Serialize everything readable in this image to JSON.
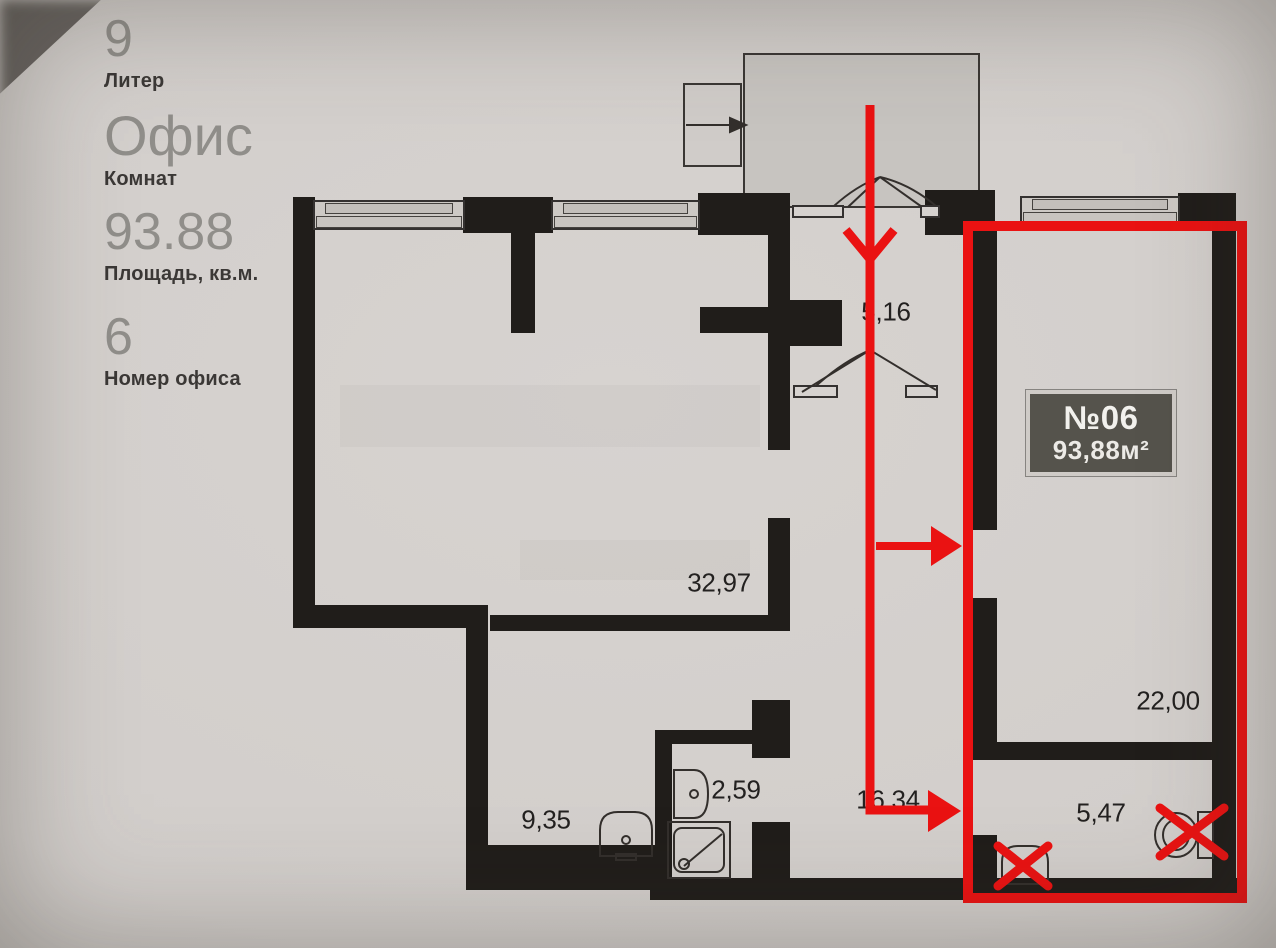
{
  "sidebar": {
    "liter": {
      "value": "9",
      "label": "Литер"
    },
    "type": {
      "value": "Офис",
      "label": "Комнат"
    },
    "area": {
      "value": "93.88",
      "label": "Площадь, кв.м."
    },
    "number": {
      "value": "6",
      "label": "Номер офиса"
    }
  },
  "badge": {
    "unit": "№06",
    "area": "93,88м²"
  },
  "rooms": {
    "entry": {
      "area": "5,16"
    },
    "living": {
      "area": "32,97"
    },
    "bedroom": {
      "area": "22,00"
    },
    "corridor": {
      "area": "16,34"
    },
    "room": {
      "area": "9,35"
    },
    "bathroom": {
      "area": "2,59"
    },
    "wc": {
      "area": "5,47"
    }
  },
  "colors": {
    "annotation_red": "#e81212",
    "wall_black": "#201d1a",
    "paper": "#d2cecb",
    "badge_bg": "#55534c"
  }
}
